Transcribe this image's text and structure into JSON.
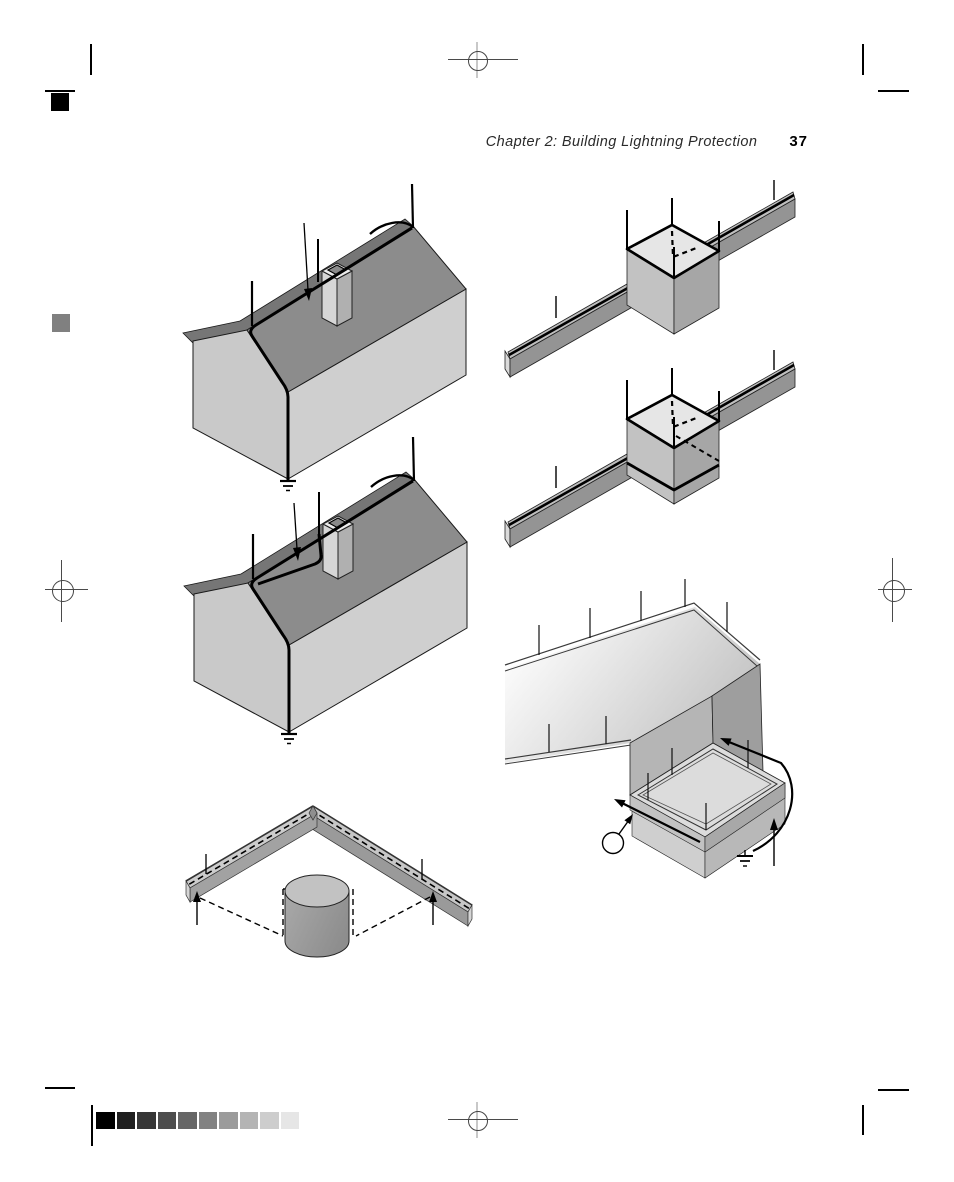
{
  "header": {
    "chapter_heading": "Chapter 2:  Building Lightning Protection",
    "page_number": "37"
  },
  "figures": [
    {
      "id": "house-ridge-conductor",
      "desc": "gable-roof house with air terminals, ridge conductor, chimney terminal and down conductor to ground"
    },
    {
      "id": "house-roof-conductor-chimney-loop",
      "desc": "gable-roof house with roof conductor routed to chimney and down conductor to ground"
    },
    {
      "id": "parapet-box-corner-terminals",
      "desc": "rooftop structure on parapet wall with corner air terminals and dashed cross-run conductor"
    },
    {
      "id": "parapet-box-base-loop",
      "desc": "rooftop structure on parapet wall with air terminals and conductor loop around its base"
    },
    {
      "id": "two-level-roof-corner",
      "desc": "two-level building corner with parapet air terminals, conductor path arrows, callout circle and ground symbol"
    },
    {
      "id": "parapet-corner-cylinder",
      "desc": "parapet corner with dashed conductor, air terminals and cylindrical roof unit with dashed protection zone"
    }
  ],
  "calibration_bar": {
    "shades": [
      "#000000",
      "#1f1f1f",
      "#363636",
      "#4d4d4d",
      "#666666",
      "#828282",
      "#9b9b9b",
      "#b4b4b4",
      "#cdcdcd",
      "#e6e6e6"
    ]
  },
  "palette": {
    "roof_dark": "#8c8c8c",
    "roof_back_sliver": "#767676",
    "gable_wall": "#c9c9c9",
    "front_wall": "#cfcfcf",
    "chimney_front": "#d6d6d6",
    "chimney_side": "#b0b0b0",
    "wall_top": "#bfbfbf",
    "wall_side": "#949494",
    "box_top": "#e6e6e6",
    "box_front": "#c2c2c2",
    "box_side": "#a6a6a6",
    "slab_top": "#dcdcdc",
    "line": "#000000",
    "page_bg": "#ffffff"
  }
}
